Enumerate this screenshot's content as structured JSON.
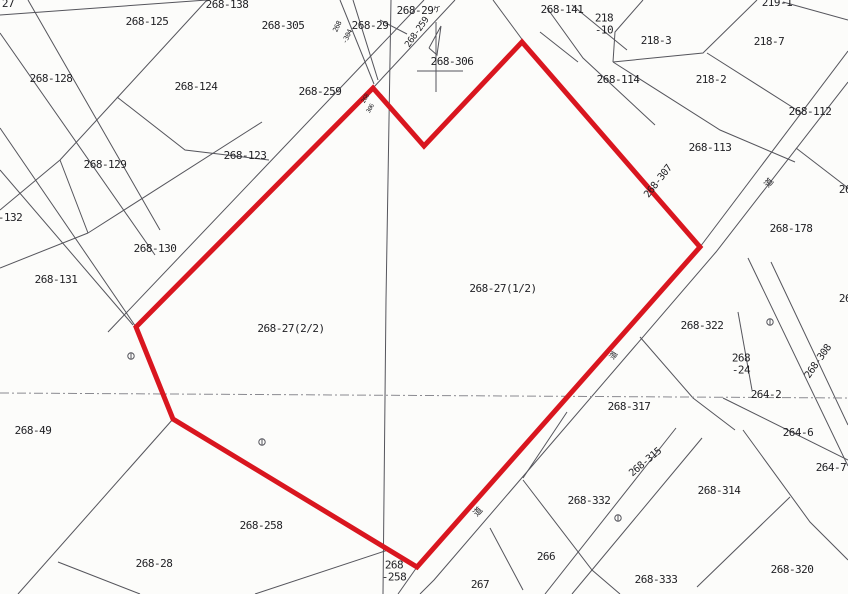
{
  "map": {
    "title": "cadastral-parcel-map",
    "highlight": {
      "color": "#d9161f",
      "parcel_ids": [
        "268-27(1/2)",
        "268-27(2/2)"
      ],
      "vertices": [
        [
          136,
          327
        ],
        [
          373,
          88
        ],
        [
          424,
          146
        ],
        [
          522,
          42
        ],
        [
          700,
          247
        ],
        [
          417,
          567
        ],
        [
          173,
          419
        ]
      ]
    },
    "labels": [
      {
        "text": "27",
        "x": 8,
        "y": 4,
        "rot": 0,
        "fs": 11
      },
      {
        "text": "268-125",
        "x": 147,
        "y": 22,
        "rot": 0,
        "fs": 11
      },
      {
        "text": "268-138",
        "x": 227,
        "y": 5,
        "rot": 0,
        "fs": 11
      },
      {
        "text": "268-305",
        "x": 283,
        "y": 26,
        "rot": 0,
        "fs": 11
      },
      {
        "text": "268-29",
        "x": 415,
        "y": 11,
        "rot": 0,
        "fs": 11
      },
      {
        "text": "ケ",
        "x": 437,
        "y": 10,
        "rot": -15,
        "fs": 8
      },
      {
        "text": "268-29",
        "x": 370,
        "y": 26,
        "rot": 0,
        "fs": 11
      },
      {
        "text": "268-259",
        "x": 418,
        "y": 33,
        "rot": -55,
        "fs": 9
      },
      {
        "text": "268",
        "x": 338,
        "y": 27,
        "rot": -65,
        "fs": 7
      },
      {
        "text": "-304",
        "x": 348,
        "y": 37,
        "rot": -65,
        "fs": 7
      },
      {
        "text": "268-306",
        "x": 452,
        "y": 62,
        "rot": 0,
        "fs": 11
      },
      {
        "text": "268",
        "x": 366,
        "y": 99,
        "rot": -60,
        "fs": 6
      },
      {
        "text": "306",
        "x": 371,
        "y": 109,
        "rot": -60,
        "fs": 6
      },
      {
        "text": "268-141",
        "x": 562,
        "y": 10,
        "rot": 0,
        "fs": 11
      },
      {
        "text": "218\n-10",
        "x": 604,
        "y": 24,
        "rot": 0,
        "fs": 11
      },
      {
        "text": "218-3",
        "x": 656,
        "y": 41,
        "rot": 0,
        "fs": 11
      },
      {
        "text": "219-1",
        "x": 777,
        "y": 3,
        "rot": 0,
        "fs": 11
      },
      {
        "text": "218-7",
        "x": 769,
        "y": 42,
        "rot": 0,
        "fs": 11
      },
      {
        "text": "268-114",
        "x": 618,
        "y": 80,
        "rot": 0,
        "fs": 11
      },
      {
        "text": "218-2",
        "x": 711,
        "y": 80,
        "rot": 0,
        "fs": 11
      },
      {
        "text": "268-112",
        "x": 810,
        "y": 112,
        "rot": 0,
        "fs": 11
      },
      {
        "text": "268-113",
        "x": 710,
        "y": 148,
        "rot": 0,
        "fs": 11
      },
      {
        "text": "268-307",
        "x": 659,
        "y": 182,
        "rot": -52,
        "fs": 10
      },
      {
        "text": "道",
        "x": 770,
        "y": 184,
        "rot": -50,
        "fs": 9
      },
      {
        "text": "26",
        "x": 845,
        "y": 190,
        "rot": 0,
        "fs": 11
      },
      {
        "text": "268-178",
        "x": 791,
        "y": 229,
        "rot": 0,
        "fs": 11
      },
      {
        "text": "26",
        "x": 845,
        "y": 299,
        "rot": 0,
        "fs": 11
      },
      {
        "text": "268-27(1/2)",
        "x": 503,
        "y": 289,
        "rot": 0,
        "fs": 11
      },
      {
        "text": "268-27(2/2)",
        "x": 291,
        "y": 329,
        "rot": 0,
        "fs": 11
      },
      {
        "text": "-132",
        "x": 10,
        "y": 218,
        "rot": 0,
        "fs": 11
      },
      {
        "text": "268-130",
        "x": 155,
        "y": 249,
        "rot": 0,
        "fs": 11
      },
      {
        "text": "268-131",
        "x": 56,
        "y": 280,
        "rot": 0,
        "fs": 11
      },
      {
        "text": "268-128",
        "x": 51,
        "y": 79,
        "rot": 0,
        "fs": 11
      },
      {
        "text": "268-129",
        "x": 105,
        "y": 165,
        "rot": 0,
        "fs": 11
      },
      {
        "text": "268-123",
        "x": 245,
        "y": 156,
        "rot": 0,
        "fs": 11
      },
      {
        "text": "268-124",
        "x": 196,
        "y": 87,
        "rot": 0,
        "fs": 11
      },
      {
        "text": "268-259",
        "x": 320,
        "y": 92,
        "rot": 0,
        "fs": 11
      },
      {
        "text": "268-49",
        "x": 33,
        "y": 431,
        "rot": 0,
        "fs": 11
      },
      {
        "text": "268-28",
        "x": 154,
        "y": 564,
        "rot": 0,
        "fs": 11
      },
      {
        "text": "268-258",
        "x": 261,
        "y": 526,
        "rot": 0,
        "fs": 11
      },
      {
        "text": "268\n-258",
        "x": 394,
        "y": 571,
        "rot": 0,
        "fs": 11
      },
      {
        "text": "267",
        "x": 480,
        "y": 585,
        "rot": 0,
        "fs": 11
      },
      {
        "text": "266",
        "x": 546,
        "y": 557,
        "rot": 0,
        "fs": 11
      },
      {
        "text": "道",
        "x": 479,
        "y": 513,
        "rot": -48,
        "fs": 9
      },
      {
        "text": "268-332",
        "x": 589,
        "y": 501,
        "rot": 0,
        "fs": 11
      },
      {
        "text": "268-333",
        "x": 656,
        "y": 580,
        "rot": 0,
        "fs": 11
      },
      {
        "text": "268-320",
        "x": 792,
        "y": 570,
        "rot": 0,
        "fs": 11
      },
      {
        "text": "268-314",
        "x": 719,
        "y": 491,
        "rot": 0,
        "fs": 11
      },
      {
        "text": "268-315",
        "x": 646,
        "y": 463,
        "rot": -40,
        "fs": 10
      },
      {
        "text": "268-317",
        "x": 629,
        "y": 407,
        "rot": 0,
        "fs": 11
      },
      {
        "text": "道",
        "x": 614,
        "y": 356,
        "rot": -55,
        "fs": 8
      },
      {
        "text": "268-322",
        "x": 702,
        "y": 326,
        "rot": 0,
        "fs": 11
      },
      {
        "text": "268\n-24",
        "x": 741,
        "y": 364,
        "rot": 0,
        "fs": 11
      },
      {
        "text": "264-2",
        "x": 766,
        "y": 395,
        "rot": 0,
        "fs": 11
      },
      {
        "text": "264-6",
        "x": 798,
        "y": 433,
        "rot": 0,
        "fs": 11
      },
      {
        "text": "264-7",
        "x": 831,
        "y": 468,
        "rot": 0,
        "fs": 11
      },
      {
        "text": "268-308",
        "x": 819,
        "y": 362,
        "rot": -55,
        "fs": 10
      }
    ],
    "lines": [
      {
        "pts": [
          [
            0,
            15
          ],
          [
            207,
            0
          ]
        ]
      },
      {
        "pts": [
          [
            207,
            0
          ],
          [
            117,
            98
          ],
          [
            60,
            160
          ]
        ]
      },
      {
        "pts": [
          [
            0,
            210
          ],
          [
            60,
            160
          ]
        ]
      },
      {
        "pts": [
          [
            60,
            160
          ],
          [
            88,
            233
          ]
        ]
      },
      {
        "pts": [
          [
            88,
            233
          ],
          [
            0,
            268
          ]
        ]
      },
      {
        "pts": [
          [
            88,
            233
          ],
          [
            262,
            122
          ]
        ]
      },
      {
        "pts": [
          [
            117,
            97
          ],
          [
            185,
            150
          ],
          [
            269,
            160
          ]
        ]
      },
      {
        "pts": [
          [
            28,
            0
          ],
          [
            160,
            230
          ]
        ]
      },
      {
        "pts": [
          [
            0,
            33
          ],
          [
            155,
            255
          ]
        ]
      },
      {
        "pts": [
          [
            0,
            128
          ],
          [
            136,
            327
          ]
        ]
      },
      {
        "pts": [
          [
            0,
            170
          ],
          [
            133,
            325
          ]
        ]
      },
      {
        "pts": [
          [
            424,
            0
          ],
          [
            108,
            332
          ]
        ]
      },
      {
        "pts": [
          [
            455,
            0
          ],
          [
            373,
            88
          ]
        ]
      },
      {
        "pts": [
          [
            340,
            0
          ],
          [
            374,
            84
          ]
        ]
      },
      {
        "pts": [
          [
            353,
            0
          ],
          [
            378,
            80
          ]
        ]
      },
      {
        "pts": [
          [
            380,
            20
          ],
          [
            407,
            34
          ]
        ]
      },
      {
        "pts": [
          [
            391,
            0
          ],
          [
            386,
            300
          ],
          [
            383,
            594
          ]
        ]
      },
      {
        "pts": [
          [
            436,
            22
          ],
          [
            436,
            92
          ]
        ]
      },
      {
        "pts": [
          [
            417,
            71
          ],
          [
            463,
            71
          ]
        ]
      },
      {
        "pts": [
          [
            429,
            48
          ],
          [
            441,
            26
          ],
          [
            437,
            55
          ],
          [
            429,
            48
          ]
        ]
      },
      {
        "pts": [
          [
            493,
            0
          ],
          [
            524,
            42
          ]
        ]
      },
      {
        "pts": [
          [
            547,
            8
          ],
          [
            583,
            58
          ],
          [
            655,
            125
          ]
        ]
      },
      {
        "pts": [
          [
            540,
            32
          ],
          [
            578,
            62
          ]
        ]
      },
      {
        "pts": [
          [
            572,
            5
          ],
          [
            627,
            50
          ]
        ]
      },
      {
        "pts": [
          [
            643,
            0
          ],
          [
            615,
            32
          ],
          [
            613,
            62
          ]
        ]
      },
      {
        "pts": [
          [
            613,
            62
          ],
          [
            703,
            53
          ],
          [
            757,
            0
          ]
        ]
      },
      {
        "pts": [
          [
            613,
            62
          ],
          [
            720,
            130
          ],
          [
            795,
            162
          ]
        ]
      },
      {
        "pts": [
          [
            707,
            53
          ],
          [
            800,
            112
          ]
        ]
      },
      {
        "pts": [
          [
            783,
            2
          ],
          [
            848,
            20
          ]
        ]
      },
      {
        "pts": [
          [
            848,
            51
          ],
          [
            700,
            247
          ]
        ]
      },
      {
        "pts": [
          [
            848,
            82
          ],
          [
            716,
            252
          ],
          [
            434,
            580
          ],
          [
            420,
            594
          ]
        ]
      },
      {
        "pts": [
          [
            417,
            567
          ],
          [
            398,
            594
          ]
        ]
      },
      {
        "pts": [
          [
            796,
            148
          ],
          [
            848,
            188
          ]
        ]
      },
      {
        "pts": [
          [
            748,
            258
          ],
          [
            848,
            466
          ]
        ]
      },
      {
        "pts": [
          [
            771,
            262
          ],
          [
            848,
            425
          ]
        ]
      },
      {
        "pts": [
          [
            640,
            337
          ],
          [
            693,
            398
          ],
          [
            735,
            430
          ]
        ]
      },
      {
        "pts": [
          [
            738,
            312
          ],
          [
            752,
            390
          ]
        ]
      },
      {
        "pts": [
          [
            723,
            398
          ],
          [
            848,
            460
          ]
        ]
      },
      {
        "pts": [
          [
            743,
            430
          ],
          [
            810,
            522
          ],
          [
            848,
            560
          ]
        ]
      },
      {
        "pts": [
          [
            676,
            428
          ],
          [
            545,
            594
          ]
        ]
      },
      {
        "pts": [
          [
            702,
            438
          ],
          [
            572,
            594
          ]
        ]
      },
      {
        "pts": [
          [
            790,
            497
          ],
          [
            697,
            587
          ]
        ]
      },
      {
        "pts": [
          [
            523,
            480
          ],
          [
            592,
            570
          ],
          [
            620,
            594
          ]
        ]
      },
      {
        "pts": [
          [
            490,
            528
          ],
          [
            523,
            590
          ]
        ]
      },
      {
        "pts": [
          [
            523,
            478
          ],
          [
            567,
            412
          ]
        ]
      },
      {
        "pts": [
          [
            173,
            419
          ],
          [
            18,
            594
          ]
        ]
      },
      {
        "pts": [
          [
            58,
            562
          ],
          [
            140,
            594
          ]
        ]
      },
      {
        "pts": [
          [
            388,
            550
          ],
          [
            255,
            594
          ]
        ]
      },
      {
        "pts": [
          [
            0,
            393
          ],
          [
            848,
            398
          ]
        ],
        "dash": true
      }
    ],
    "markers": [
      {
        "x": 131,
        "y": 356
      },
      {
        "x": 262,
        "y": 442
      },
      {
        "x": 618,
        "y": 518
      },
      {
        "x": 770,
        "y": 322
      }
    ]
  }
}
